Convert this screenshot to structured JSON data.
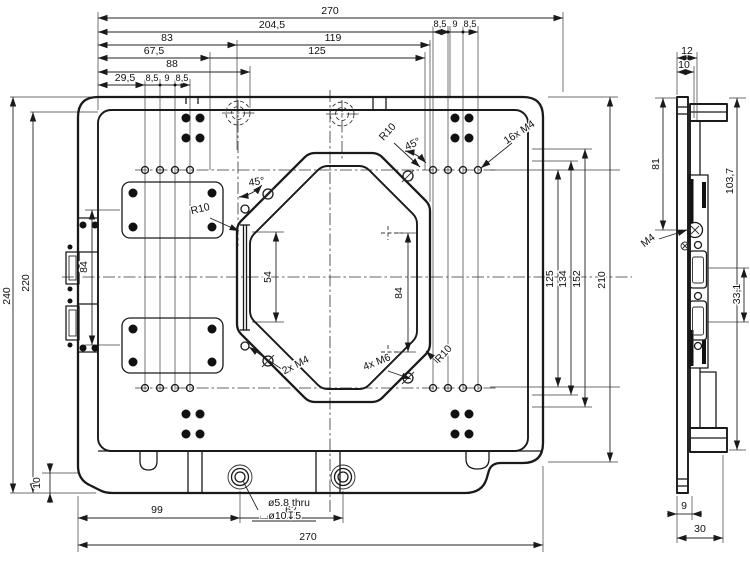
{
  "colors": {
    "background": "#ffffff",
    "line": "#1a1a1a"
  },
  "front": {
    "dims_top": {
      "d270": "270",
      "d204_5": "204,5",
      "d83": "83",
      "d119": "119",
      "d67_5": "67,5",
      "d125": "125",
      "d88": "88",
      "d29_5": "29,5",
      "left_spacing": [
        "8,5",
        "9",
        "8,5"
      ],
      "right_spacing": [
        "8,5",
        "9",
        "8,5"
      ]
    },
    "dims_left": {
      "d240": "240",
      "d220": "220",
      "d84": "84",
      "d10": "10"
    },
    "dims_inner": {
      "d54": "54",
      "d84": "84"
    },
    "dims_right": {
      "d125": "125",
      "d134": "134",
      "d152": "152",
      "d210": "210"
    },
    "dims_bottom": {
      "d99": "99",
      "d62": "62",
      "d270": "270"
    },
    "hole_note": {
      "line1": "ø5.8 thru",
      "line2": "⌴ø10↧5"
    },
    "labels": {
      "r10_left": "R10",
      "r10_top": "R10",
      "r10_bottom": "R10",
      "angle_left": "45°",
      "angle_right": "45°",
      "m4_16": "16x M4",
      "m4_2": "2x M4",
      "m6_4": "4x M6"
    }
  },
  "side": {
    "dims": {
      "d12": "12",
      "d10": "10",
      "d81": "81",
      "d103_7": "103,7",
      "d33_1": "33,1",
      "d9": "9",
      "d30": "30"
    },
    "labels": {
      "m4": "M4"
    }
  }
}
